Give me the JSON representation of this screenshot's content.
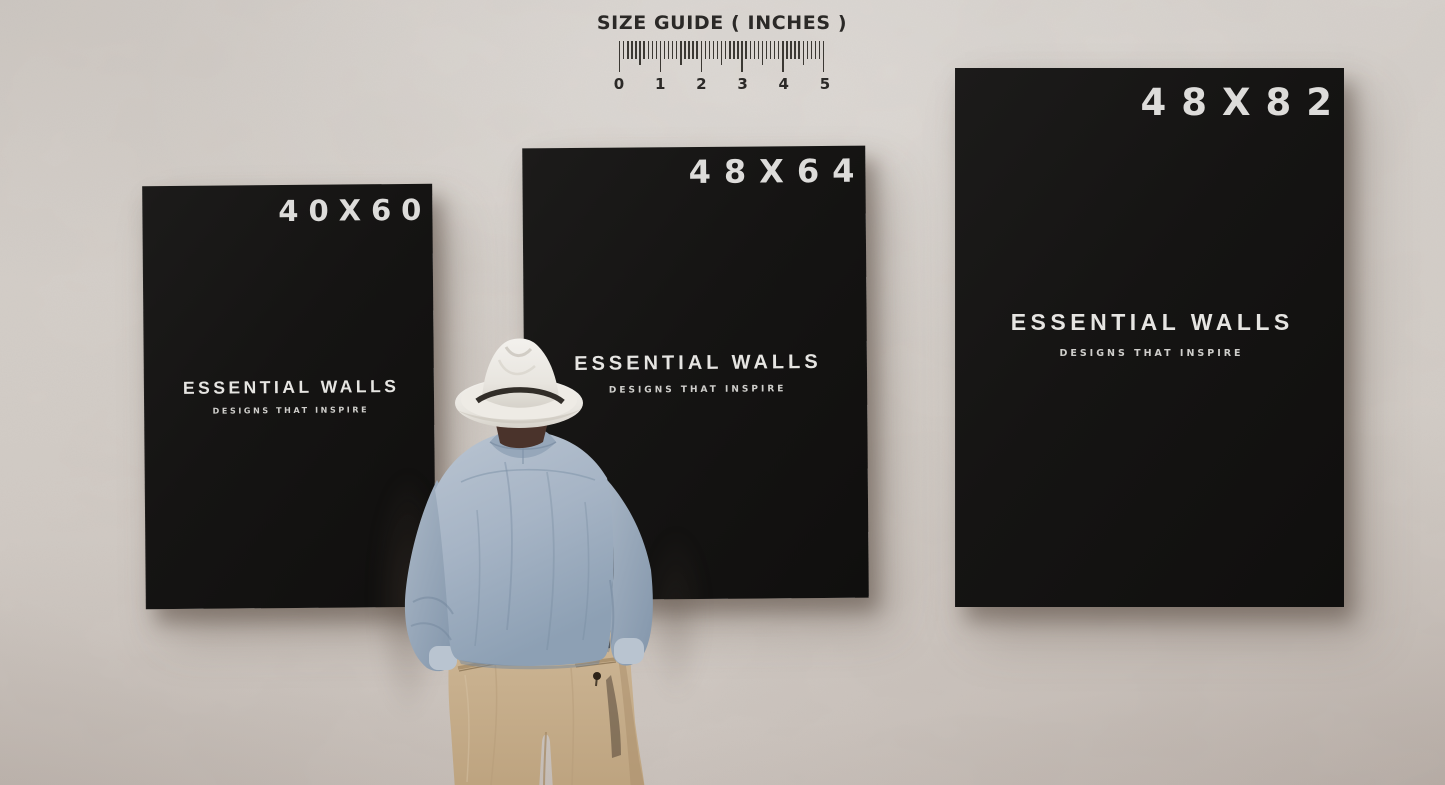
{
  "size_guide": {
    "title": "SIZE GUIDE ( INCHES )",
    "unit_labels": [
      "0",
      "1",
      "2",
      "3",
      "4",
      "5"
    ],
    "inches": 5,
    "minor_ticks_per_inch": 10
  },
  "posters": [
    {
      "size_label": "40X60",
      "brand": "ESSENTIAL WALLS",
      "tagline": "DESIGNS THAT INSPIRE"
    },
    {
      "size_label": "48X64",
      "brand": "ESSENTIAL WALLS",
      "tagline": "DESIGNS THAT INSPIRE"
    },
    {
      "size_label": "48X82",
      "brand": "ESSENTIAL WALLS",
      "tagline": "DESIGNS THAT INSPIRE"
    }
  ],
  "colors": {
    "wall": "#d4cec8",
    "canvas": "#151413",
    "canvas_text": "#e6e5e2",
    "guide_text": "#2b2927",
    "hat": "#ece9e4",
    "hat_band": "#221d19",
    "shirt": "#a6b4c5",
    "trousers": "#c8b192"
  }
}
